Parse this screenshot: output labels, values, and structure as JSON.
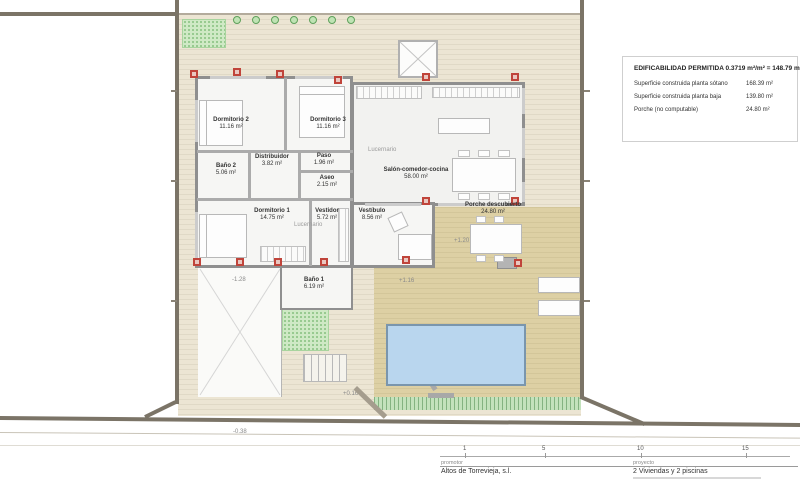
{
  "info_box": {
    "title": "EDIFICABILIDAD PERMITIDA 0.3719 m²/m² = 148.79 m²",
    "rows": [
      {
        "label": "Superficie construida planta sótano",
        "value": "168.39 m²"
      },
      {
        "label": "Superficie construida planta baja",
        "value": "139.80 m²"
      },
      {
        "label": "Porche (no computable)",
        "value": "24.80 m²"
      }
    ]
  },
  "rooms": {
    "dormitorio1": {
      "name": "Dormitorio 1",
      "area": "14.75 m²"
    },
    "dormitorio2": {
      "name": "Dormitorio 2",
      "area": "11.16 m²"
    },
    "dormitorio3": {
      "name": "Dormitorio 3",
      "area": "11.16 m²"
    },
    "bano1": {
      "name": "Baño 1",
      "area": "6.19 m²"
    },
    "bano2": {
      "name": "Baño 2",
      "area": "5.06 m²"
    },
    "aseo": {
      "name": "Aseo",
      "area": "2.15 m²"
    },
    "distribuidor": {
      "name": "Distribuidor",
      "area": "3.82 m²"
    },
    "paso": {
      "name": "Paso",
      "area": "1.96 m²"
    },
    "vestidor": {
      "name": "Vestidor",
      "area": "5.72 m²"
    },
    "vestibulo": {
      "name": "Vestíbulo",
      "area": "8.56 m²"
    },
    "salon": {
      "name": "Salón-comedor-cocina",
      "area": "58.00 m²"
    },
    "porche": {
      "name": "Porche descubierto",
      "area": "24.80 m²"
    }
  },
  "annotations": {
    "lucernario": "Lucernario",
    "levels": {
      "porche": "+1.20",
      "terraza": "+1.16",
      "rampa": "-1.28",
      "escalera": "+0.16",
      "acera": "-0.38"
    }
  },
  "title_block": {
    "scale_ticks": [
      "1",
      "5",
      "10",
      "15"
    ],
    "promotor_label": "promotor",
    "promotor_name": "Altos de Torrevieja, s.l.",
    "proyecto_label": "proyecto",
    "proyecto_name": "2 Viviendas y 2 piscinas"
  },
  "colors": {
    "plot_ground": "#ece5d3",
    "terrace": "#ddd0a4",
    "pool_water": "#b9d6ee",
    "vegetation": "#cfe9c5",
    "column_marker": "#c0443a",
    "boundary": "#7b7467"
  }
}
